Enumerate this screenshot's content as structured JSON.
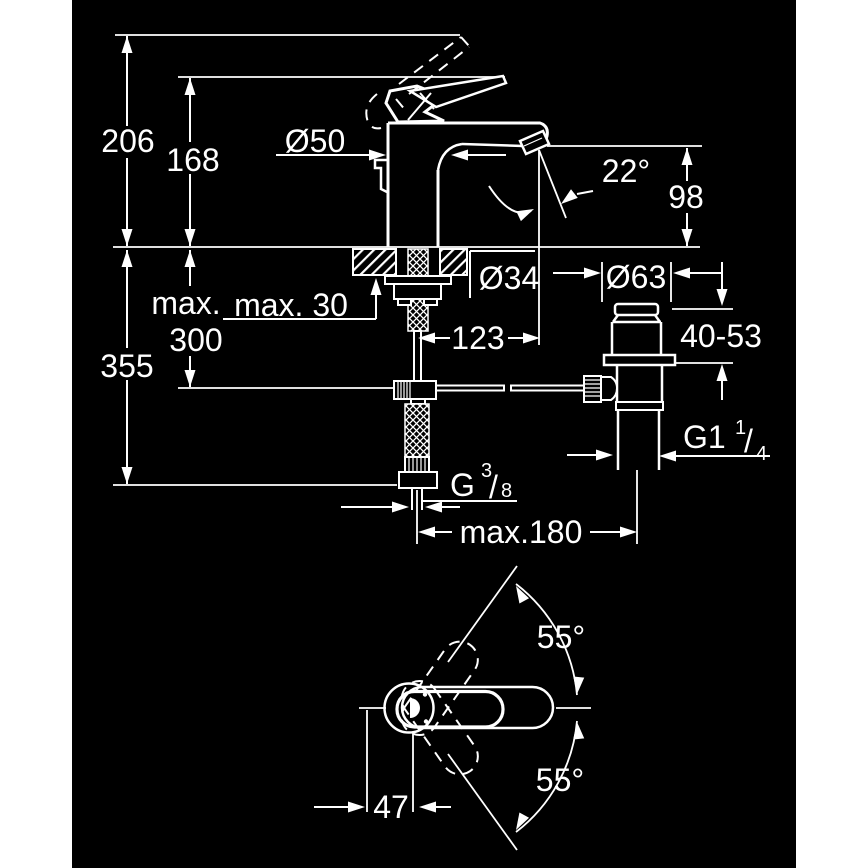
{
  "drawing": {
    "background": "#000000",
    "line_color": "#ffffff",
    "page_background": "#ffffff",
    "dimensions": {
      "total_height": "206",
      "handle_height": "168",
      "body_diameter": "Ø50",
      "aerator_angle": "22°",
      "spout_height": "98",
      "hose_length_prefix": "max.",
      "hose_length_value": "300",
      "deck_thickness": "max. 30",
      "deck_hole_diameter": "Ø34",
      "install_depth": "355",
      "spout_projection": "123",
      "waste_flange_diameter": "Ø63",
      "waste_clamp_range": "40-53",
      "pop_up_rod_reach": "max.180",
      "handle_swing_upper": "55°",
      "handle_swing_lower": "55°",
      "handle_offset": "47",
      "waste_thread": {
        "base": "G1",
        "numerator": "1",
        "slash": "/",
        "denominator": "4"
      },
      "supply_thread": {
        "base": "G",
        "numerator": "3",
        "slash": "/",
        "denominator": "8"
      }
    }
  }
}
